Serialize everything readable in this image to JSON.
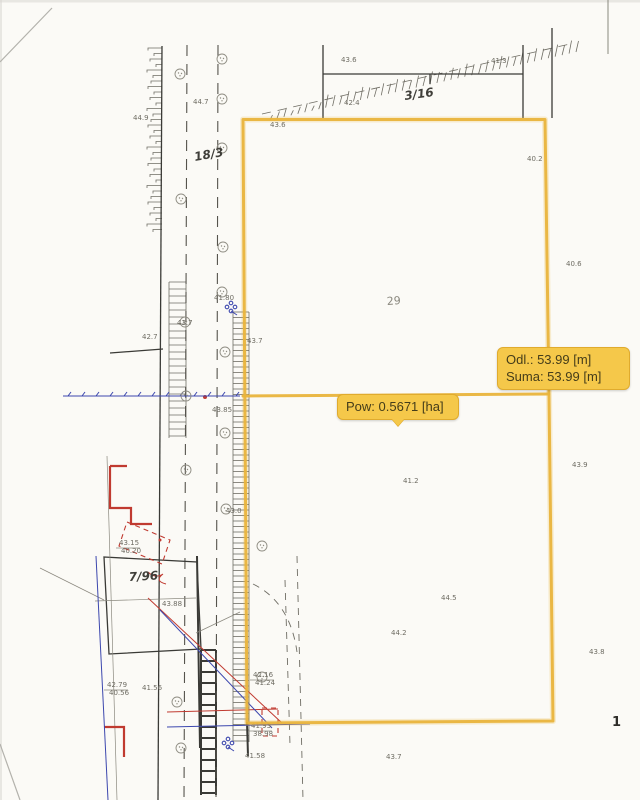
{
  "overlay": {
    "distance_tooltip": {
      "line1": "Odl.: 53.99 [m]",
      "line2": "Suma: 53.99 [m]"
    },
    "area_tooltip": {
      "label": "Pow: 0.5671 [ha]"
    }
  },
  "parcel_labels": [
    {
      "id": "18-3",
      "text": "18/3"
    },
    {
      "id": "3-16",
      "text": "3/16"
    },
    {
      "id": "29",
      "text": "29"
    },
    {
      "id": "7-96",
      "text": "7/96"
    }
  ],
  "page_number": "1",
  "elevation_labels": [
    {
      "text": "44.9",
      "x": 133,
      "y": 120
    },
    {
      "text": "44.7",
      "x": 193,
      "y": 104
    },
    {
      "text": "43.6",
      "x": 341,
      "y": 62
    },
    {
      "text": "41.3",
      "x": 491,
      "y": 63
    },
    {
      "text": "42.4",
      "x": 344,
      "y": 105
    },
    {
      "text": "43.6",
      "x": 270,
      "y": 127
    },
    {
      "text": "40.2",
      "x": 527,
      "y": 161
    },
    {
      "text": "40.6",
      "x": 566,
      "y": 266
    },
    {
      "text": "42.7",
      "x": 142,
      "y": 339
    },
    {
      "text": "43.7",
      "x": 177,
      "y": 325
    },
    {
      "text": "43.7",
      "x": 247,
      "y": 343
    },
    {
      "text": "41.80",
      "x": 214,
      "y": 300
    },
    {
      "text": "43.85",
      "x": 212,
      "y": 412
    },
    {
      "text": "43.0",
      "x": 226,
      "y": 513
    },
    {
      "text": "43.9",
      "x": 572,
      "y": 467
    },
    {
      "text": "41.2",
      "x": 403,
      "y": 483
    },
    {
      "text": "44.5",
      "x": 441,
      "y": 600
    },
    {
      "text": "44.2",
      "x": 391,
      "y": 635
    },
    {
      "text": "43.8",
      "x": 589,
      "y": 654
    },
    {
      "text": "43.7",
      "x": 386,
      "y": 759
    },
    {
      "text": "43.88",
      "x": 162,
      "y": 606
    },
    {
      "text": "43.15",
      "x": 119,
      "y": 545
    },
    {
      "text": "40.20",
      "x": 121,
      "y": 553
    },
    {
      "text": "42.79",
      "x": 107,
      "y": 687
    },
    {
      "text": "40.56",
      "x": 109,
      "y": 695
    },
    {
      "text": "41.56",
      "x": 142,
      "y": 690
    },
    {
      "text": "42.16",
      "x": 253,
      "y": 677
    },
    {
      "text": "41.24",
      "x": 255,
      "y": 685
    },
    {
      "text": "41.93",
      "x": 251,
      "y": 728
    },
    {
      "text": "38.98",
      "x": 253,
      "y": 736
    },
    {
      "text": "41.58",
      "x": 245,
      "y": 758
    }
  ],
  "colors": {
    "paper": "#fbfaf6",
    "ink": "#3a3a36",
    "red": "#c03a30",
    "blue": "#3c47ae",
    "overlay": "#e9b43c",
    "tooltip_bg": "#f5c84a",
    "tooltip_border": "#e0ab2d",
    "tooltip_text": "#453d1a"
  }
}
